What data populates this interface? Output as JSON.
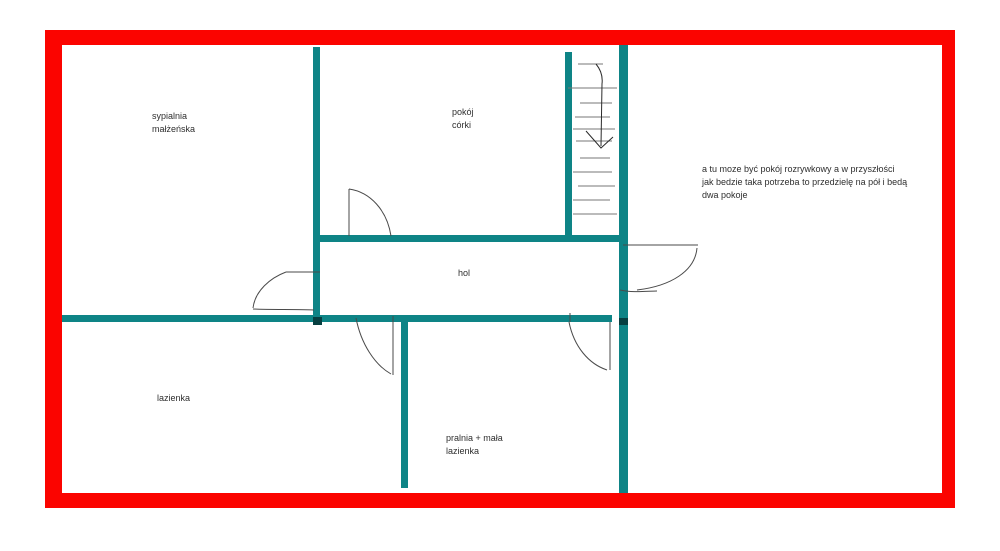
{
  "colors": {
    "frame": "#fb0400",
    "wall": "#0e8486",
    "wall_dark": "#073f41"
  },
  "rooms": {
    "master_bedroom": {
      "line1": "sypialnia",
      "line2": "małżeńska"
    },
    "daughters_room": {
      "line1": "pokój",
      "line2": "córki"
    },
    "hall": {
      "label": "hol"
    },
    "bathroom": {
      "label": "lazienka"
    },
    "laundry": {
      "line1": "pralnia + mała",
      "line2": "lazienka"
    }
  },
  "annotation": {
    "line1": "a tu moze być pokój rozrywkowy a w przyszłości",
    "line2": "jak bedzie taka potrzeba to przedzielę na pół i bedą",
    "line3": "dwa pokoje"
  }
}
